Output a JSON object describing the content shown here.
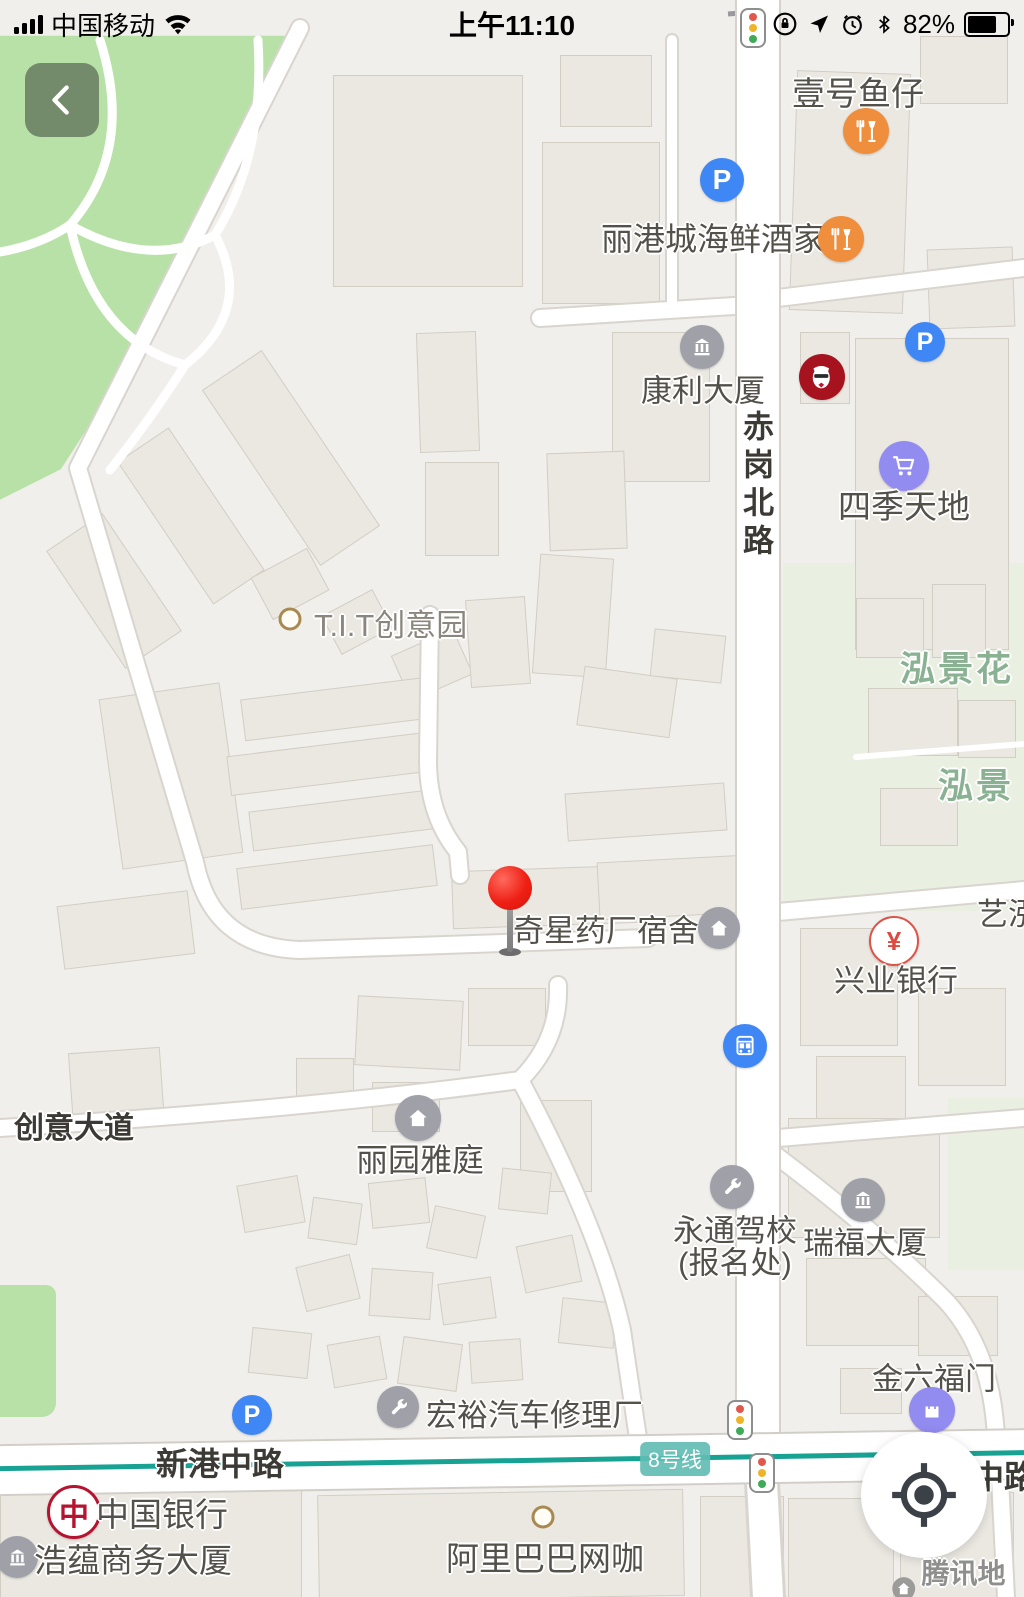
{
  "status_bar": {
    "carrier": "中国移动",
    "time": "上午11:10",
    "battery_percent": "82%"
  },
  "icons": {
    "parking_glyph": "P",
    "yuan_glyph": "¥",
    "boc_glyph": "中"
  },
  "map": {
    "roads": {
      "chigang_north_road": "赤岗北路",
      "xingang_middle_road": "新港中路",
      "chuangyi_avenue": "创意大道",
      "zhonglu_partial": "中路"
    },
    "metro": {
      "line_badge": "8号线"
    },
    "pois": {
      "yihao_yuzai": "壹号鱼仔",
      "ligangcheng": "丽港城海鲜酒家",
      "kangli_daxia": "康利大厦",
      "siji_tiandi": "四季天地",
      "tit_park": "T.I.T创意园",
      "hongjing_hua": "泓景花",
      "hongjing": "泓景",
      "yihong": "艺泓",
      "xingye_bank": "兴业银行",
      "qixing_dorm": "奇星药厂宿舍",
      "liyuan_yating": "丽园雅庭",
      "yongtong_line1": "永通驾校",
      "yongtong_line2": "(报名处)",
      "ruifu_daxia": "瑞福大厦",
      "jinliufu_men": "金六福门",
      "hongyu_repair": "宏裕汽车修理厂",
      "bank_of_china": "中国银行",
      "haoyun_daxia": "浩蕴商务大厦",
      "alibaba_cafe": "阿里巴巴网咖"
    },
    "watermark": "腾讯地图"
  }
}
